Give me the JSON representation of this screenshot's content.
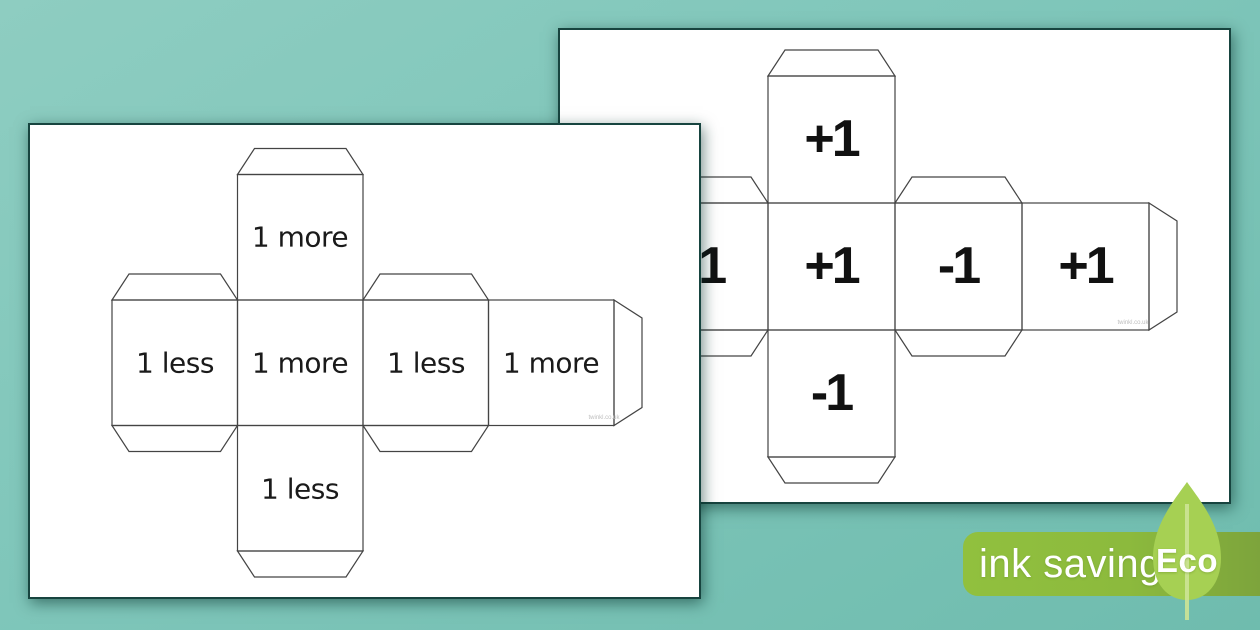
{
  "front_page": {
    "faces": {
      "top": "1 more",
      "middle": [
        "1 less",
        "1 more",
        "1 less",
        "1 more"
      ],
      "bottom": "1 less"
    },
    "watermark": "twinkl.co.uk"
  },
  "back_page": {
    "faces": {
      "top": "+1",
      "middle": [
        "-1",
        "+1",
        "-1",
        "+1"
      ],
      "bottom": "-1"
    },
    "watermark": "twinkl.co.uk"
  },
  "badge": {
    "label": "ink saving",
    "eco_label": "Eco"
  },
  "colors": {
    "background_teal": "#7fc6ba",
    "page_border": "#17443f",
    "net_line": "#444444",
    "banner_green": "#8cba3d",
    "leaf_green": "#a6d053",
    "text_black": "#1a1a1a"
  }
}
